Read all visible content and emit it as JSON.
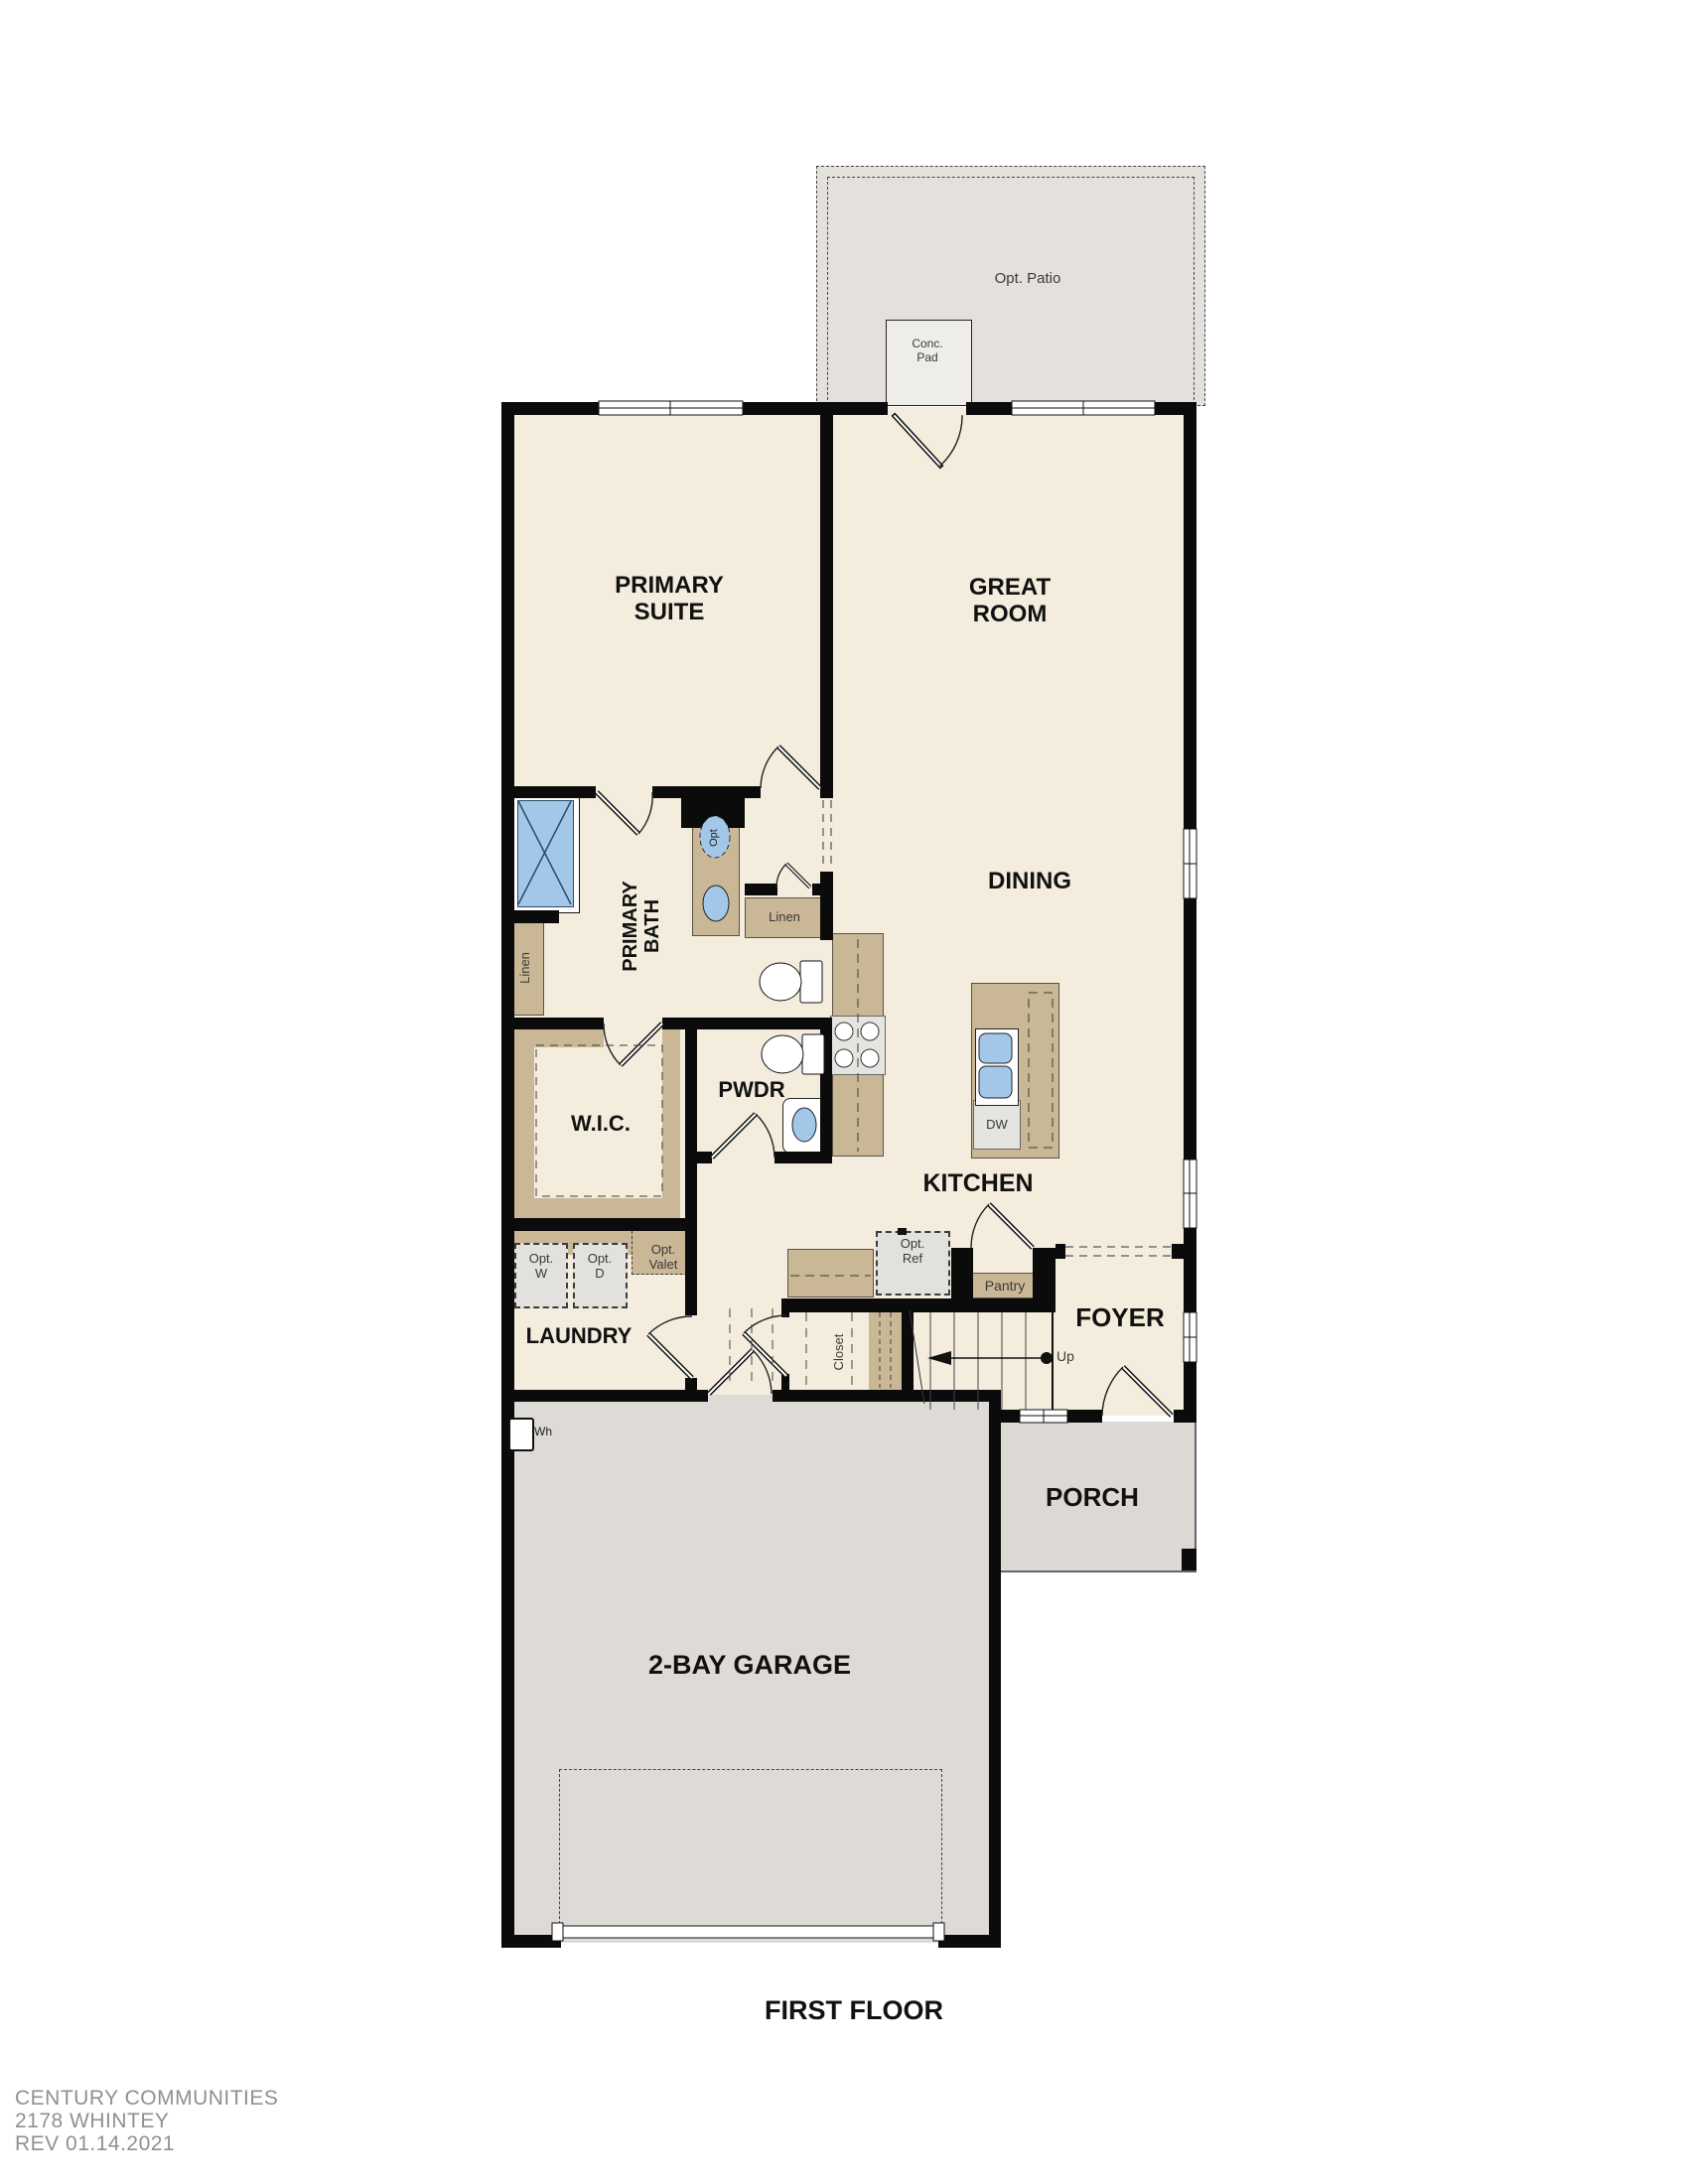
{
  "plan": {
    "title": "FIRST FLOOR",
    "footer": {
      "company": "CENTURY COMMUNITIES",
      "model": "2178 WHINTEY",
      "revision": "REV 01.14.2021"
    },
    "rooms": {
      "primary_suite": "PRIMARY SUITE",
      "great_room": "GREAT ROOM",
      "dining": "DINING",
      "kitchen": "KITCHEN",
      "primary_bath": "PRIMARY BATH",
      "wic": "W.I.C.",
      "pwdr": "PWDR",
      "laundry": "LAUNDRY",
      "foyer": "FOYER",
      "porch": "PORCH",
      "garage": "2-BAY GARAGE"
    },
    "features": {
      "opt_patio": "Opt. Patio",
      "conc_pad": "Conc. Pad",
      "linen_bath": "Linen",
      "linen_hall": "Linen",
      "opt_sink": "Opt",
      "dw": "DW",
      "opt_ref": "Opt. Ref",
      "pantry": "Pantry",
      "closet": "Closet",
      "up": "Up",
      "opt_washer": "Opt. W",
      "opt_dryer": "Opt. D",
      "opt_valet": "Opt. Valet",
      "water_heater": "Wh"
    },
    "colors": {
      "wall": "#0b0b0b",
      "floor": "#f4edde",
      "cabinet": "#c9b795",
      "fixture_blue": "#a3c7e8",
      "patio": "#e4e1dd",
      "garage_floor": "#dedbd7",
      "porch_floor": "#dcd8d4",
      "appliance": "#e6e4e1",
      "footer_text": "#909090"
    }
  }
}
